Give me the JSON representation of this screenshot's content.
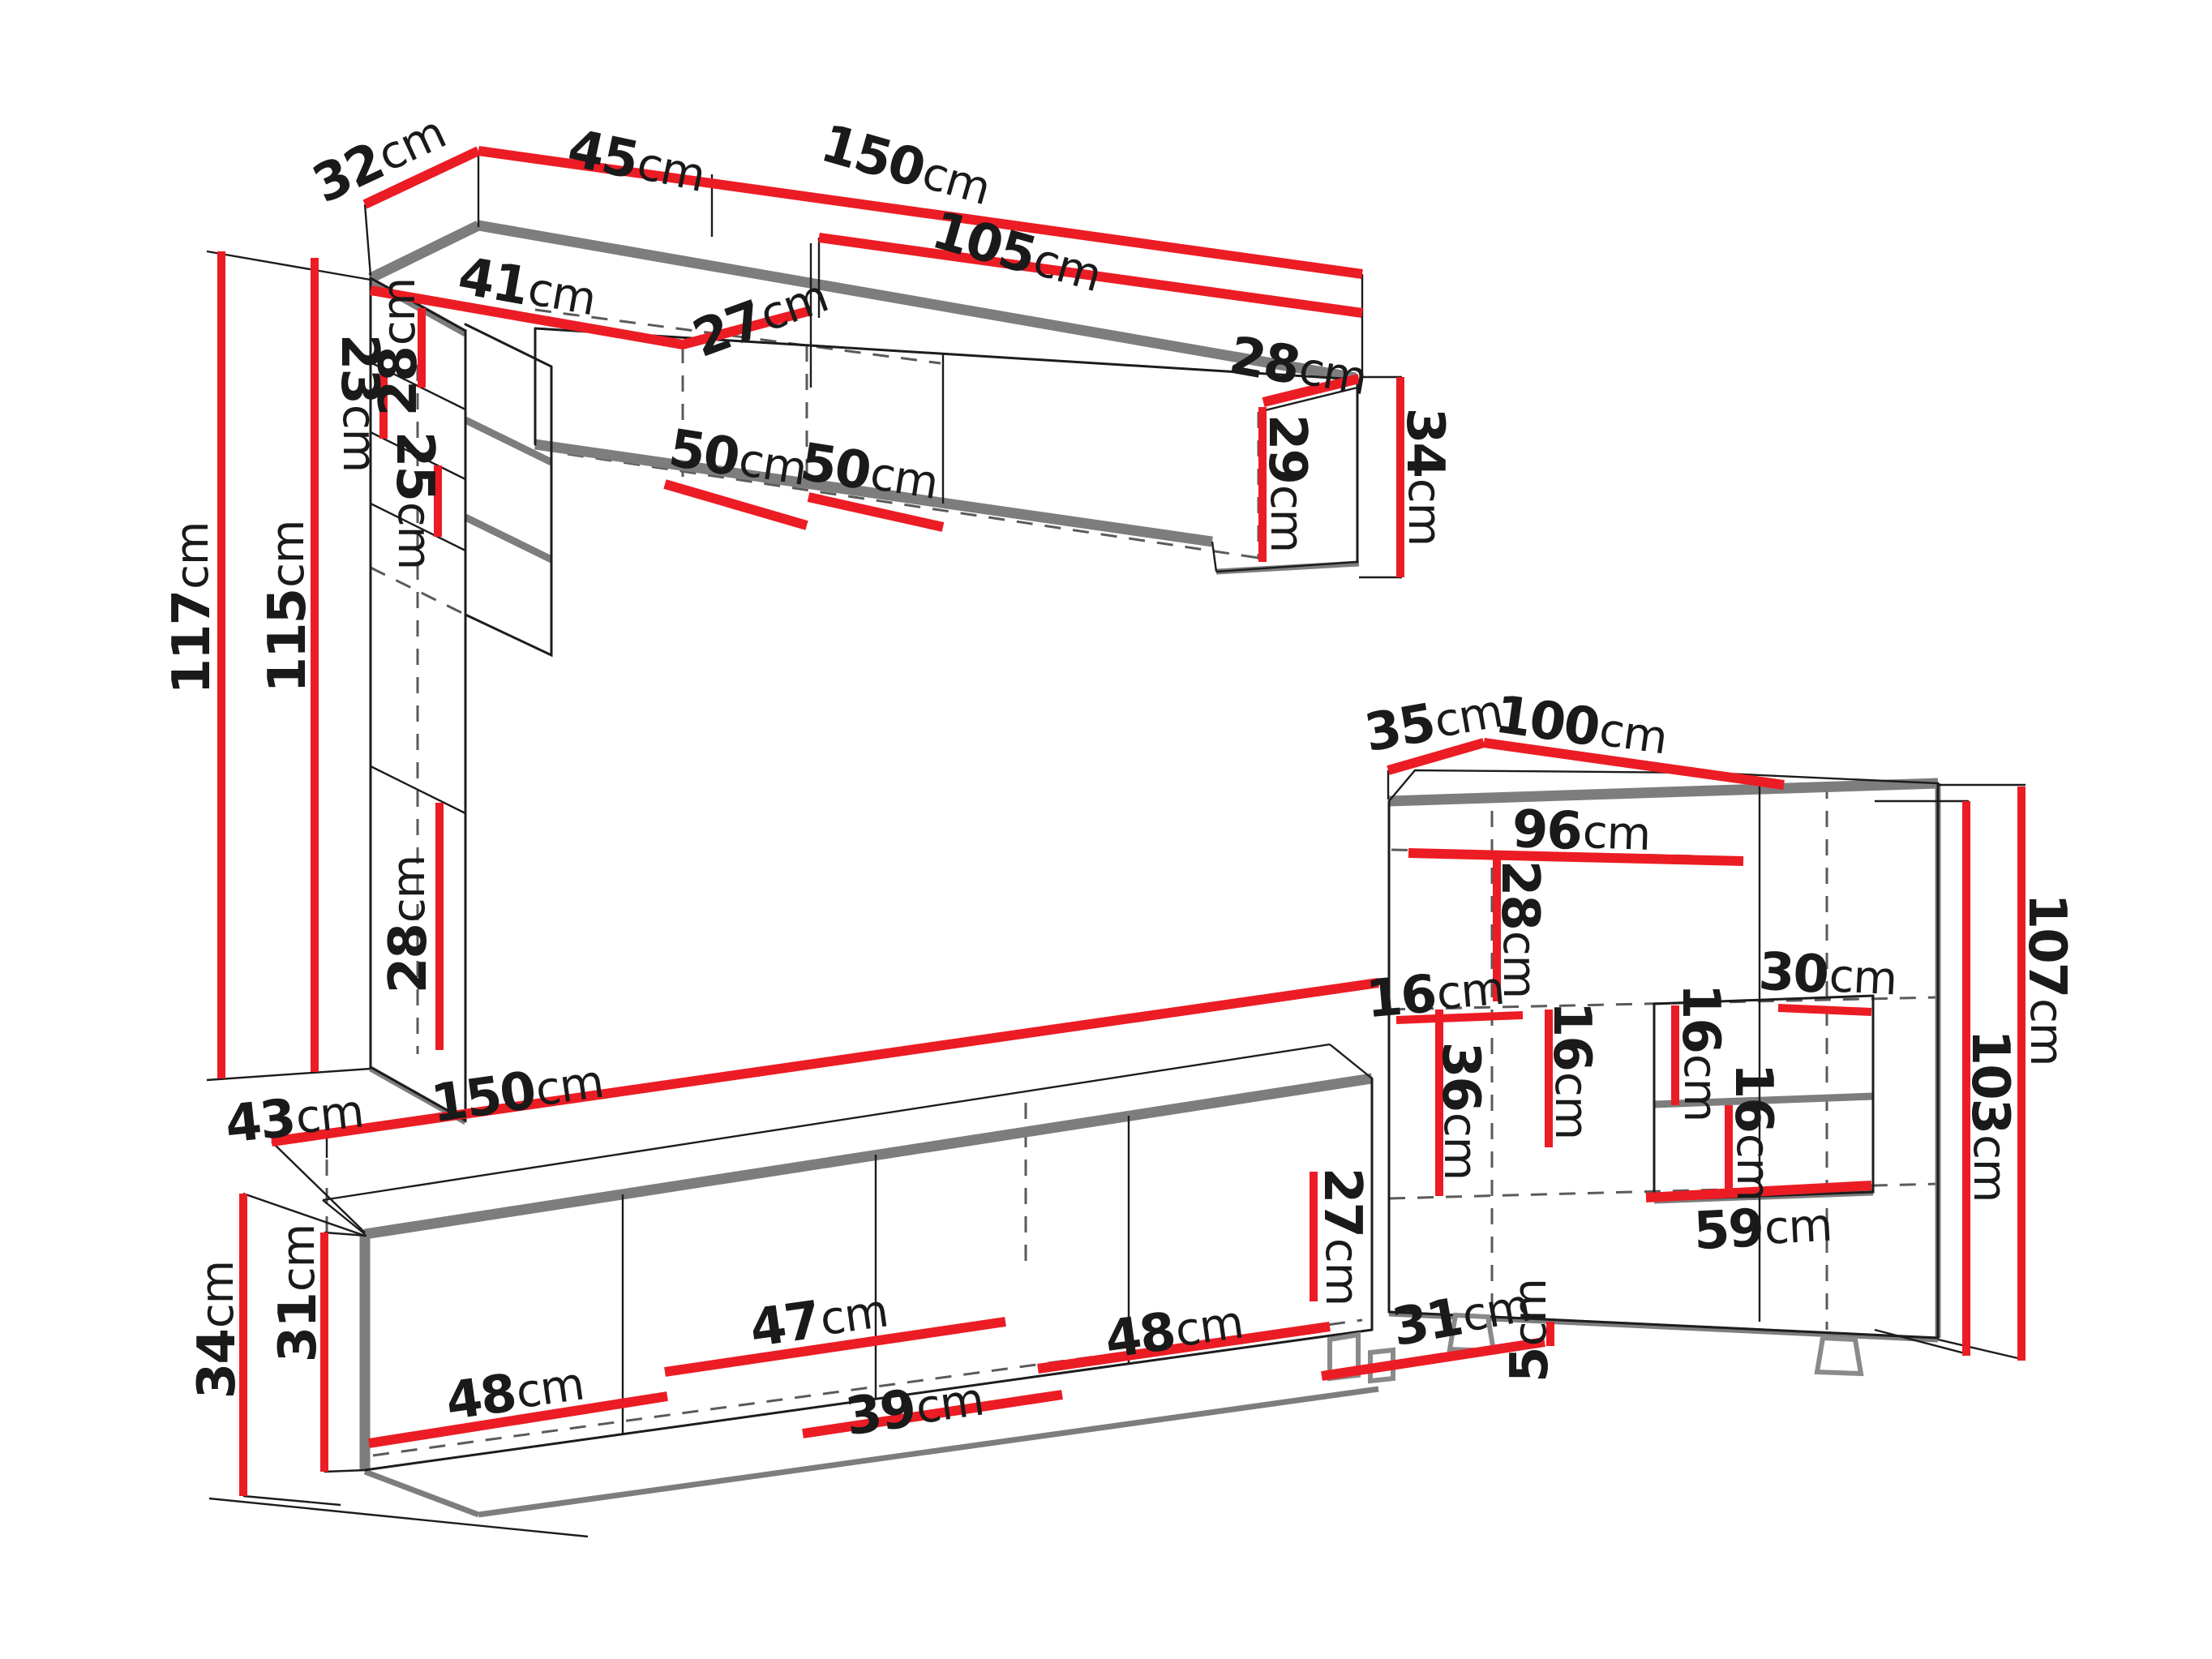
{
  "diagram": {
    "type": "furniture-dimension-drawing",
    "unit": "cm",
    "colors": {
      "dimension_line": "#ec1c24",
      "outline": "#1c1c1c",
      "shadow_edge": "#7d7d7d",
      "background": "#ffffff",
      "label_text": "#1a1a1a"
    },
    "pieces": [
      {
        "name": "wall-unit-top",
        "overall_cm": {
          "height": 117,
          "inner_height": 115,
          "depth": 32,
          "top_width": [
            45,
            150
          ],
          "front_width": 105
        }
      },
      {
        "name": "tv-stand-bottom",
        "overall_cm": {
          "width": 150,
          "left_depth": 43,
          "height": 34,
          "inner_height": 31,
          "right_height": 27
        }
      },
      {
        "name": "display-cabinet-right",
        "overall_cm": {
          "width": 100,
          "depth": 35,
          "height": 107,
          "inner_height": 103,
          "leg_height": 5
        }
      }
    ]
  },
  "labels": [
    {
      "name": "w32",
      "group": "wall-unit",
      "value": "32",
      "unit": "cm"
    },
    {
      "name": "w45",
      "group": "wall-unit",
      "value": "45",
      "unit": "cm"
    },
    {
      "name": "w150",
      "group": "wall-unit",
      "value": "150",
      "unit": "cm"
    },
    {
      "name": "w105",
      "group": "wall-unit",
      "value": "105",
      "unit": "cm"
    },
    {
      "name": "w41",
      "group": "wall-unit",
      "value": "41",
      "unit": "cm"
    },
    {
      "name": "w27",
      "group": "wall-unit",
      "value": "27",
      "unit": "cm"
    },
    {
      "name": "w28a",
      "group": "wall-unit",
      "value": "28",
      "unit": "cm"
    },
    {
      "name": "w23",
      "group": "wall-unit",
      "value": "23",
      "unit": "cm"
    },
    {
      "name": "w25",
      "group": "wall-unit",
      "value": "25",
      "unit": "cm"
    },
    {
      "name": "w28b",
      "group": "wall-unit",
      "value": "28",
      "unit": "cm"
    },
    {
      "name": "w117",
      "group": "wall-unit",
      "value": "117",
      "unit": "cm"
    },
    {
      "name": "w115",
      "group": "wall-unit",
      "value": "115",
      "unit": "cm"
    },
    {
      "name": "w50a",
      "group": "wall-unit",
      "value": "50",
      "unit": "cm"
    },
    {
      "name": "w50b",
      "group": "wall-unit",
      "value": "50",
      "unit": "cm"
    },
    {
      "name": "w28c",
      "group": "wall-unit",
      "value": "28",
      "unit": "cm"
    },
    {
      "name": "w29",
      "group": "wall-unit",
      "value": "29",
      "unit": "cm"
    },
    {
      "name": "w34",
      "group": "wall-unit",
      "value": "34",
      "unit": "cm"
    },
    {
      "name": "t43",
      "group": "tv-stand",
      "value": "43",
      "unit": "cm"
    },
    {
      "name": "t150",
      "group": "tv-stand",
      "value": "150",
      "unit": "cm"
    },
    {
      "name": "t34",
      "group": "tv-stand",
      "value": "34",
      "unit": "cm"
    },
    {
      "name": "t31",
      "group": "tv-stand",
      "value": "31",
      "unit": "cm"
    },
    {
      "name": "t48a",
      "group": "tv-stand",
      "value": "48",
      "unit": "cm"
    },
    {
      "name": "t47",
      "group": "tv-stand",
      "value": "47",
      "unit": "cm"
    },
    {
      "name": "t39",
      "group": "tv-stand",
      "value": "39",
      "unit": "cm"
    },
    {
      "name": "t48b",
      "group": "tv-stand",
      "value": "48",
      "unit": "cm"
    },
    {
      "name": "t27",
      "group": "tv-stand",
      "value": "27",
      "unit": "cm"
    },
    {
      "name": "d35",
      "group": "display-cabinet",
      "value": "35",
      "unit": "cm"
    },
    {
      "name": "d100",
      "group": "display-cabinet",
      "value": "100",
      "unit": "cm"
    },
    {
      "name": "d96",
      "group": "display-cabinet",
      "value": "96",
      "unit": "cm"
    },
    {
      "name": "d28",
      "group": "display-cabinet",
      "value": "28",
      "unit": "cm"
    },
    {
      "name": "d16a",
      "group": "display-cabinet",
      "value": "16",
      "unit": "cm"
    },
    {
      "name": "d36",
      "group": "display-cabinet",
      "value": "36",
      "unit": "cm"
    },
    {
      "name": "d16b",
      "group": "display-cabinet",
      "value": "16",
      "unit": "cm"
    },
    {
      "name": "d16c",
      "group": "display-cabinet",
      "value": "16",
      "unit": "cm"
    },
    {
      "name": "d16d",
      "group": "display-cabinet",
      "value": "16",
      "unit": "cm"
    },
    {
      "name": "d30",
      "group": "display-cabinet",
      "value": "30",
      "unit": "cm"
    },
    {
      "name": "d59",
      "group": "display-cabinet",
      "value": "59",
      "unit": "cm"
    },
    {
      "name": "d107",
      "group": "display-cabinet",
      "value": "107",
      "unit": "cm"
    },
    {
      "name": "d103",
      "group": "display-cabinet",
      "value": "103",
      "unit": "cm"
    },
    {
      "name": "d31",
      "group": "display-cabinet",
      "value": "31",
      "unit": "cm"
    },
    {
      "name": "d5",
      "group": "display-cabinet",
      "value": "5",
      "unit": "cm"
    }
  ]
}
